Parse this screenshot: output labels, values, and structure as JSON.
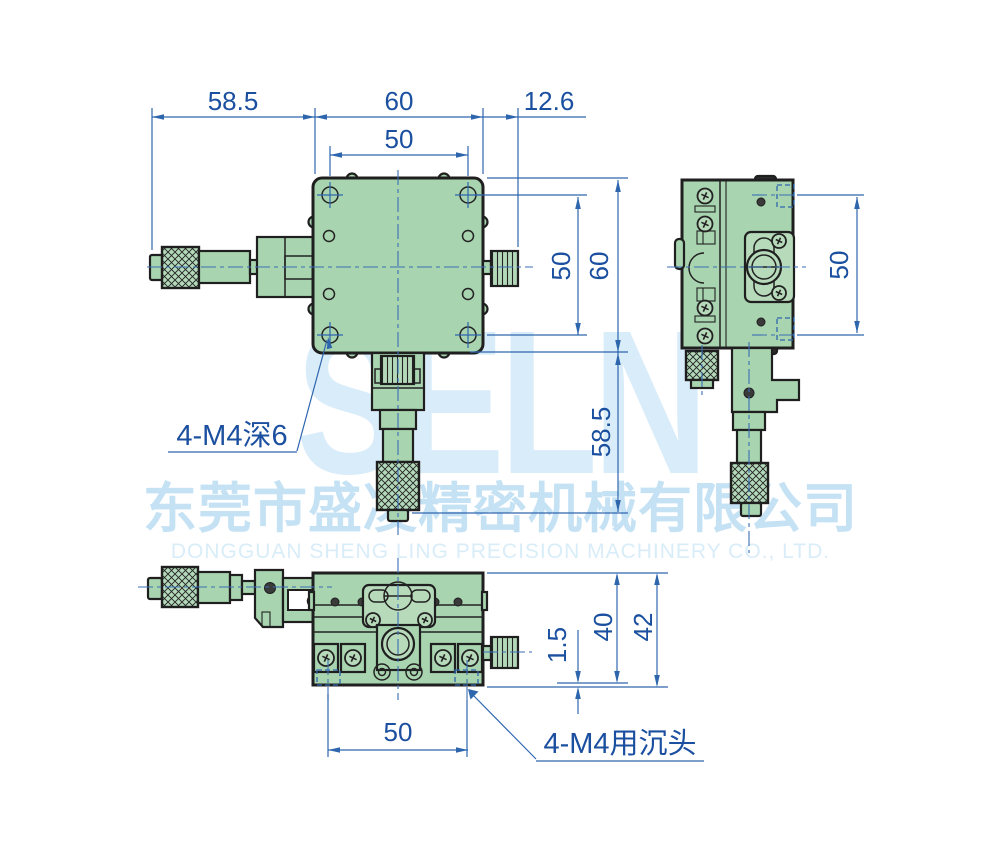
{
  "watermark": {
    "brand": "SELN",
    "company_cn": "东莞市盛凌精密机械有限公司",
    "company_en": "DONGGUAN SHENG LING PRECISION MACHINERY CO., LTD."
  },
  "labels": {
    "thread_note": "4-M4深6",
    "counterbore_note": "4-M4用沉头"
  },
  "dims": {
    "top_left": "58.5",
    "top_width": "60",
    "top_offset": "12.6",
    "top_holes": "50",
    "right_holes": "50",
    "right_height": "60",
    "right_mic": "58.5",
    "side_holes": "50",
    "front_cbore": "1.5",
    "front_h1": "40",
    "front_h2": "42",
    "front_holes": "50"
  },
  "views": {
    "top_view": {
      "body_width_mm": 60,
      "body_height_mm": 60,
      "hole_spacing_mm": 50,
      "micrometer_length_mm": 58.5,
      "knob_offset_mm": 12.6
    },
    "side_view": {
      "hole_spacing_mm": 50
    },
    "front_view": {
      "height_mm": 40,
      "total_height_mm": 42,
      "counterbore_depth_mm": 1.5,
      "hole_spacing_mm": 50
    }
  },
  "colors": {
    "dimension_blue": "#2e66ae",
    "text_blue": "#1b4f9f",
    "body_green": "#a9d4b0",
    "outline": "#1f1f1f",
    "watermark_light_blue": "#d9ecf9",
    "watermark_blue": "#c5e2f5"
  }
}
